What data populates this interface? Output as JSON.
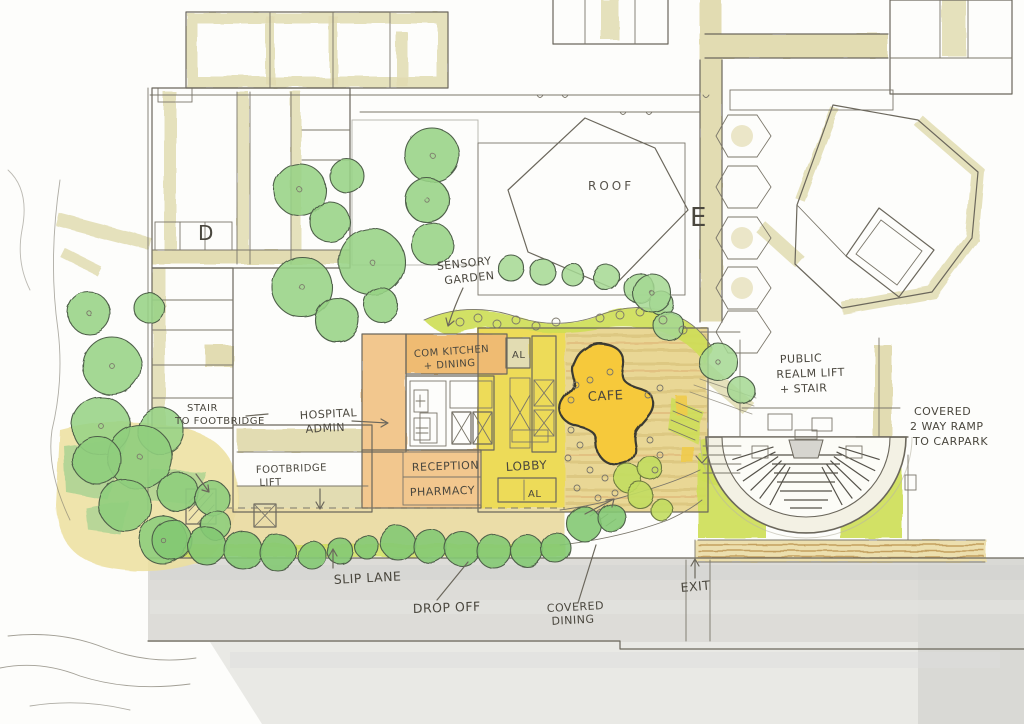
{
  "meta": {
    "type": "hand-drawn architectural site plan sketch",
    "media": "pencil and watercolour plan view"
  },
  "palette": {
    "paper": "#fdfdfb",
    "pencil": "#6b675c",
    "khaki_wall": "#e2dcb2",
    "tree_green": "#97d385",
    "tree_green_dark": "#7fc76f",
    "lime_planting": "#cdde55",
    "deck_tan": "#e9d795",
    "deck_stripe": "#d9c47c",
    "lobby_yellow": "#ecd84a",
    "cafe_gold": "#f6c93a",
    "admin_orange": "#f2c78e",
    "road_gray": "#dddcd8"
  },
  "labels": {
    "roof": {
      "text": "ROOF"
    },
    "block_d": {
      "text": "D"
    },
    "block_e": {
      "text": "E"
    },
    "sensory_garden": {
      "lines": [
        "SENSORY",
        "GARDEN"
      ]
    },
    "com_kitchen": {
      "lines": [
        "COM KITCHEN",
        "+ DINING"
      ]
    },
    "al_upper": {
      "text": "AL"
    },
    "al_lower": {
      "text": "AL"
    },
    "cafe": {
      "text": "CAFE"
    },
    "hospital_admin": {
      "lines": [
        "HOSPITAL",
        "ADMIN"
      ]
    },
    "stair_to_footbridge": {
      "lines": [
        "STAIR",
        "TO FOOTBRIDGE"
      ]
    },
    "footbridge_lift": {
      "lines": [
        "FOOTBRIDGE",
        "LIFT"
      ]
    },
    "reception": {
      "text": "RECEPTION"
    },
    "pharmacy": {
      "text": "PHARMACY"
    },
    "lobby": {
      "text": "LOBBY"
    },
    "public_realm": {
      "lines": [
        "PUBLIC",
        "REALM LIFT",
        "+ STAIR"
      ]
    },
    "covered_ramp": {
      "lines": [
        "COVERED",
        "2 WAY RAMP",
        "TO CARPARK"
      ]
    },
    "slip_lane": {
      "text": "SLIP LANE"
    },
    "drop_off": {
      "text": "DROP OFF"
    },
    "covered_dining": {
      "lines": [
        "COVERED",
        "DINING"
      ]
    },
    "exit": {
      "text": "EXIT"
    }
  }
}
